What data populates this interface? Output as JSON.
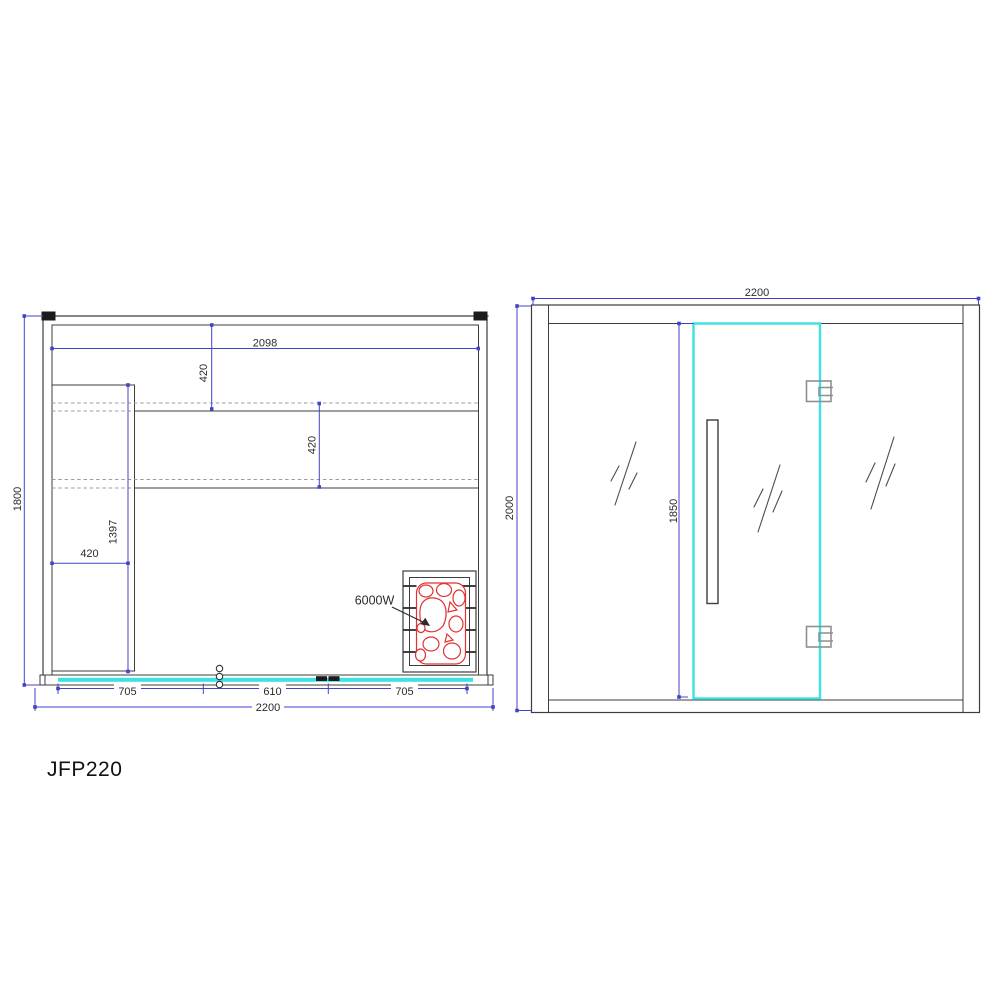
{
  "model_label": "JFP220",
  "colors": {
    "dimension_blue": "#4343c8",
    "outline_gray": "#3d3d3d",
    "hidden_line_gray": "#9c9c9c",
    "glass_cyan": "#3ae2e2",
    "heater_red": "#e03232"
  },
  "plan_view": {
    "dim_overall_width": "2200",
    "dim_overall_depth": "1800",
    "dim_back_wall_inner": "2098",
    "dim_back_bench_depth": "420",
    "dim_middle_bench_depth": "420",
    "dim_side_bench_width": "420",
    "dim_side_bench_length": "1397",
    "dim_front_left_glass": "705",
    "dim_door_width": "610",
    "dim_front_right_glass": "705",
    "heater_power": "6000W"
  },
  "front_view": {
    "dim_overall_width": "2200",
    "dim_overall_height": "2000",
    "dim_door_height": "1850"
  }
}
